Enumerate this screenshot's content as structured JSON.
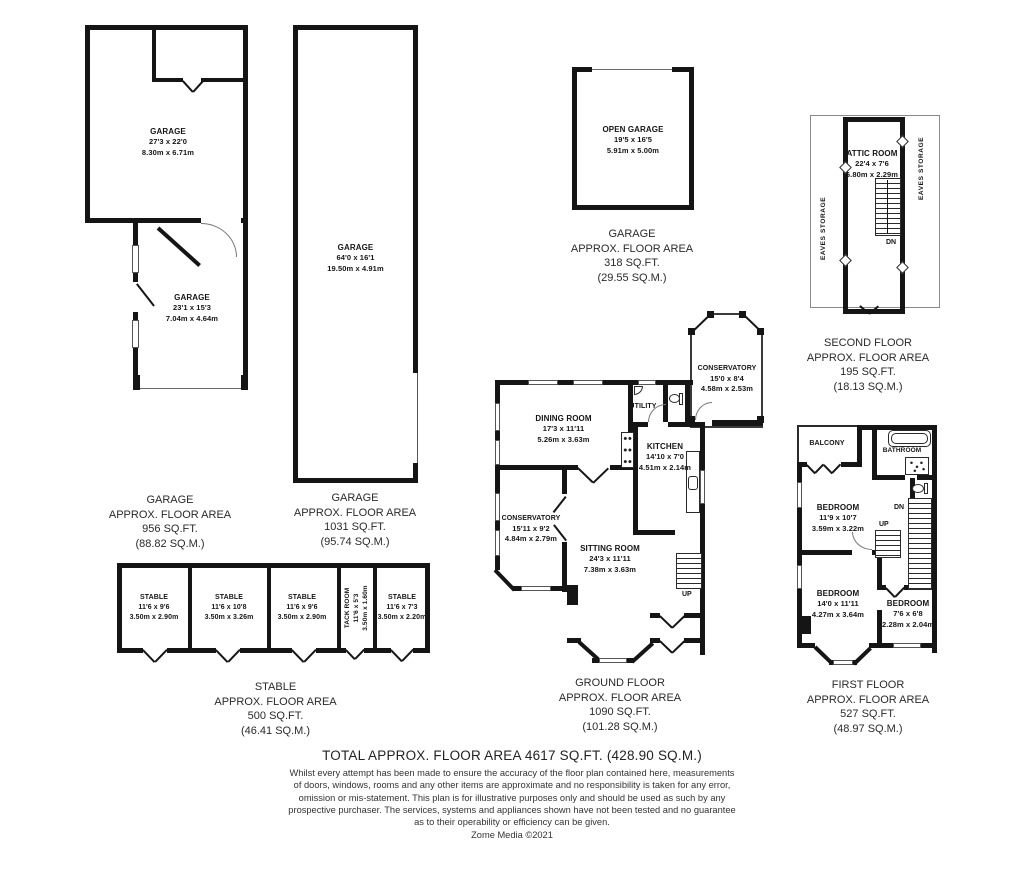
{
  "colors": {
    "wall": "#151515",
    "background": "#ffffff",
    "text": "#151515",
    "caption": "#2a2a2a"
  },
  "plans": {
    "garage_block": {
      "room_top": {
        "name": "GARAGE",
        "size_ft": "27'3 x 22'0",
        "size_m": "8.30m x 6.71m"
      },
      "room_bottom": {
        "name": "GARAGE",
        "size_ft": "23'1 x 15'3",
        "size_m": "7.04m x 4.64m"
      },
      "caption": [
        "GARAGE",
        "APPROX. FLOOR AREA",
        "956 SQ.FT.",
        "(88.82 SQ.M.)"
      ]
    },
    "garage_long": {
      "room": {
        "name": "GARAGE",
        "size_ft": "64'0 x 16'1",
        "size_m": "19.50m x 4.91m"
      },
      "caption": [
        "GARAGE",
        "APPROX. FLOOR AREA",
        "1031 SQ.FT.",
        "(95.74 SQ.M.)"
      ]
    },
    "open_garage": {
      "room": {
        "name": "OPEN GARAGE",
        "size_ft": "19'5 x 16'5",
        "size_m": "5.91m x 5.00m"
      },
      "caption": [
        "GARAGE",
        "APPROX. FLOOR AREA",
        "318 SQ.FT.",
        "(29.55 SQ.M.)"
      ]
    },
    "second_floor": {
      "attic": {
        "name": "ATTIC ROOM",
        "size_ft": "22'4 x 7'6",
        "size_m": "6.80m x 2.29m"
      },
      "eaves_left": "EAVES STORAGE",
      "eaves_right": "EAVES STORAGE",
      "stairs_dn": "DN",
      "caption": [
        "SECOND FLOOR",
        "APPROX. FLOOR AREA",
        "195 SQ.FT.",
        "(18.13 SQ.M.)"
      ]
    },
    "ground_floor": {
      "dining": {
        "name": "DINING ROOM",
        "size_ft": "17'3 x 11'11",
        "size_m": "5.26m x 3.63m"
      },
      "utility": {
        "name": "UTILITY"
      },
      "kitchen": {
        "name": "KITCHEN",
        "size_ft": "14'10 x 7'0",
        "size_m": "4.51m x 2.14m"
      },
      "conservatory_rear": {
        "name": "CONSERVATORY",
        "size_ft": "15'0 x 8'4",
        "size_m": "4.58m x 2.53m"
      },
      "conservatory_side": {
        "name": "CONSERVATORY",
        "size_ft": "15'11 x 9'2",
        "size_m": "4.84m x 2.79m"
      },
      "sitting": {
        "name": "SITTING ROOM",
        "size_ft": "24'3 x 11'11",
        "size_m": "7.38m x 3.63m"
      },
      "stairs_up": "UP",
      "caption": [
        "GROUND FLOOR",
        "APPROX. FLOOR AREA",
        "1090 SQ.FT.",
        "(101.28 SQ.M.)"
      ]
    },
    "first_floor": {
      "balcony": {
        "name": "BALCONY"
      },
      "bathroom": {
        "name": "BATHROOM"
      },
      "bedroom1": {
        "name": "BEDROOM",
        "size_ft": "11'9 x 10'7",
        "size_m": "3.59m x 3.22m"
      },
      "bedroom2": {
        "name": "BEDROOM",
        "size_ft": "14'0 x 11'11",
        "size_m": "4.27m x 3.64m"
      },
      "bedroom3": {
        "name": "BEDROOM",
        "size_ft": "7'6 x 6'8",
        "size_m": "2.28m x 2.04m"
      },
      "stairs_up": "UP",
      "stairs_dn": "DN",
      "caption": [
        "FIRST FLOOR",
        "APPROX. FLOOR AREA",
        "527 SQ.FT.",
        "(48.97 SQ.M.)"
      ]
    },
    "stables": {
      "stalls": [
        {
          "name": "STABLE",
          "size_ft": "11'6 x 9'6",
          "size_m": "3.50m x 2.90m"
        },
        {
          "name": "STABLE",
          "size_ft": "11'6 x 10'8",
          "size_m": "3.50m x 3.26m"
        },
        {
          "name": "STABLE",
          "size_ft": "11'6 x 9'6",
          "size_m": "3.50m x 2.90m"
        },
        {
          "name": "TACK ROOM",
          "size_ft": "11'6 x 5'3",
          "size_m": "3.50m x 1.60m"
        },
        {
          "name": "STABLE",
          "size_ft": "11'6 x 7'3",
          "size_m": "3.50m x 2.20m"
        }
      ],
      "caption": [
        "STABLE",
        "APPROX. FLOOR AREA",
        "500 SQ.FT.",
        "(46.41 SQ.M.)"
      ]
    }
  },
  "footer": {
    "total": "TOTAL APPROX. FLOOR AREA 4617 SQ.FT. (428.90 SQ.M.)",
    "disclaimer": [
      "Whilst every attempt has been made to ensure the accuracy of the floor plan contained here, measurements",
      "of doors, windows, rooms and any other items are approximate and no responsibility is taken for any error,",
      "omission or mis-statement. This plan is for illustrative purposes only and should be used as such by any",
      "prospective purchaser. The services, systems and appliances shown have not been tested and no guarantee",
      "as to their operability or efficiency can be given."
    ],
    "copyright": "Zome Media ©2021"
  }
}
